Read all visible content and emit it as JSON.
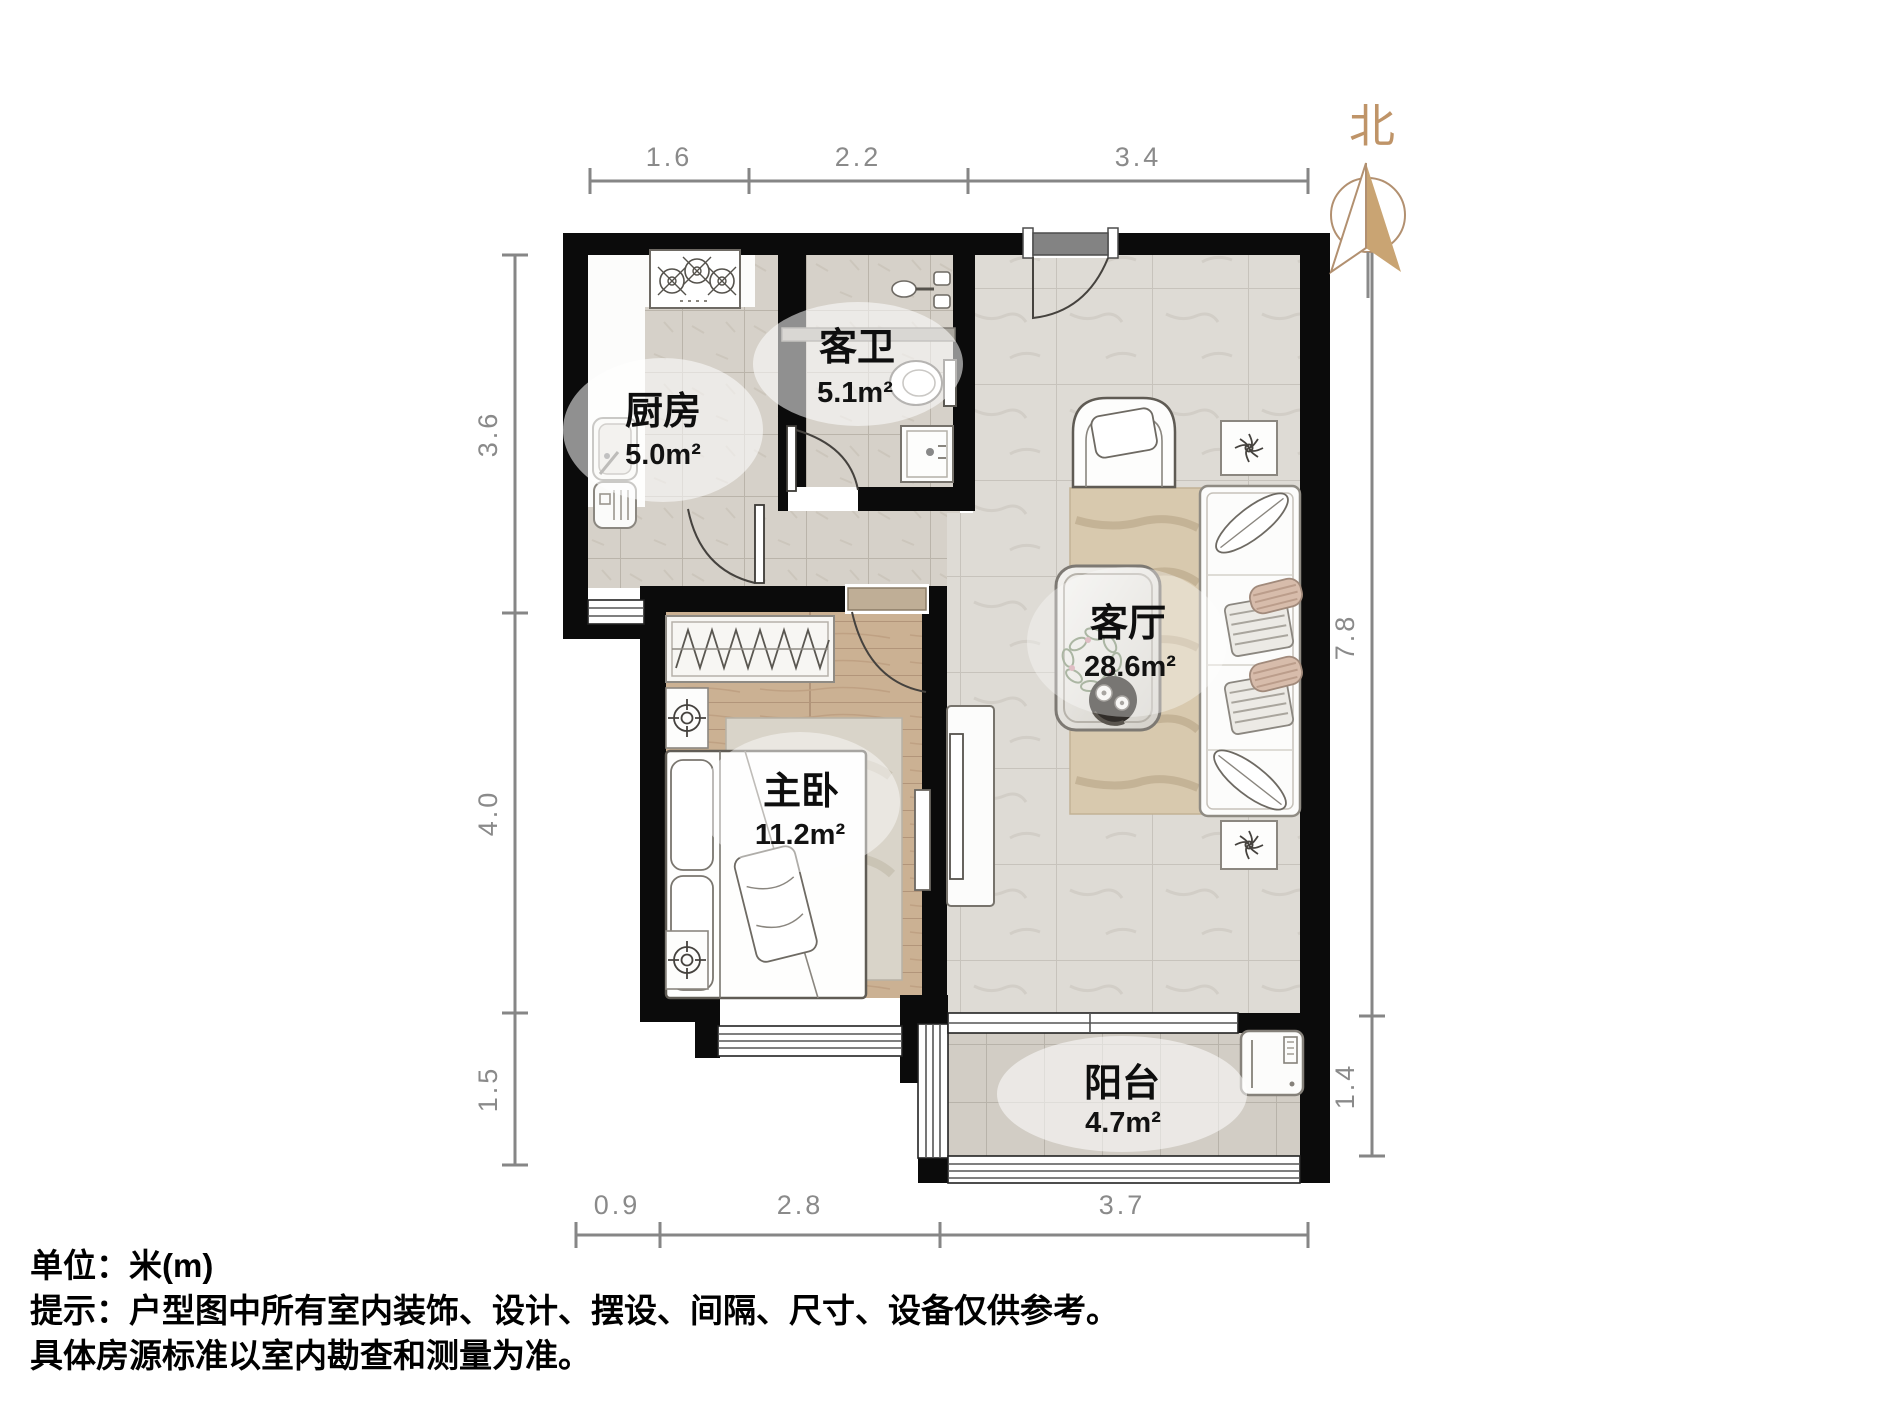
{
  "title": "户型图",
  "north_label": "北",
  "rooms": [
    {
      "name": "厨房",
      "area": "5.0m²"
    },
    {
      "name": "客卫",
      "area": "5.1m²"
    },
    {
      "name": "客厅",
      "area": "28.6m²"
    },
    {
      "name": "主卧",
      "area": "11.2m²"
    },
    {
      "name": "阳台",
      "area": "4.7m²"
    }
  ],
  "dimensions": {
    "top": [
      "1.6",
      "2.2",
      "3.4"
    ],
    "left": [
      "3.6",
      "4.0",
      "1.5"
    ],
    "right": [
      "7.8",
      "1.4"
    ],
    "bottom": [
      "0.9",
      "2.8",
      "3.7"
    ]
  },
  "notes": {
    "unit": "单位：米(m)",
    "tip1": "提示：户型图中所有室内装饰、设计、摆设、间隔、尺寸、设备仅供参考。",
    "tip2": "具体房源标准以室内勘查和测量为准。"
  },
  "colors": {
    "wall": "#0b0b0b",
    "dimension": "#868686",
    "north_accent": "#bf9468",
    "wood_floor": "#cbb193",
    "tile_floor": "#d6d1c9",
    "marble_floor": "#dedbd5"
  }
}
